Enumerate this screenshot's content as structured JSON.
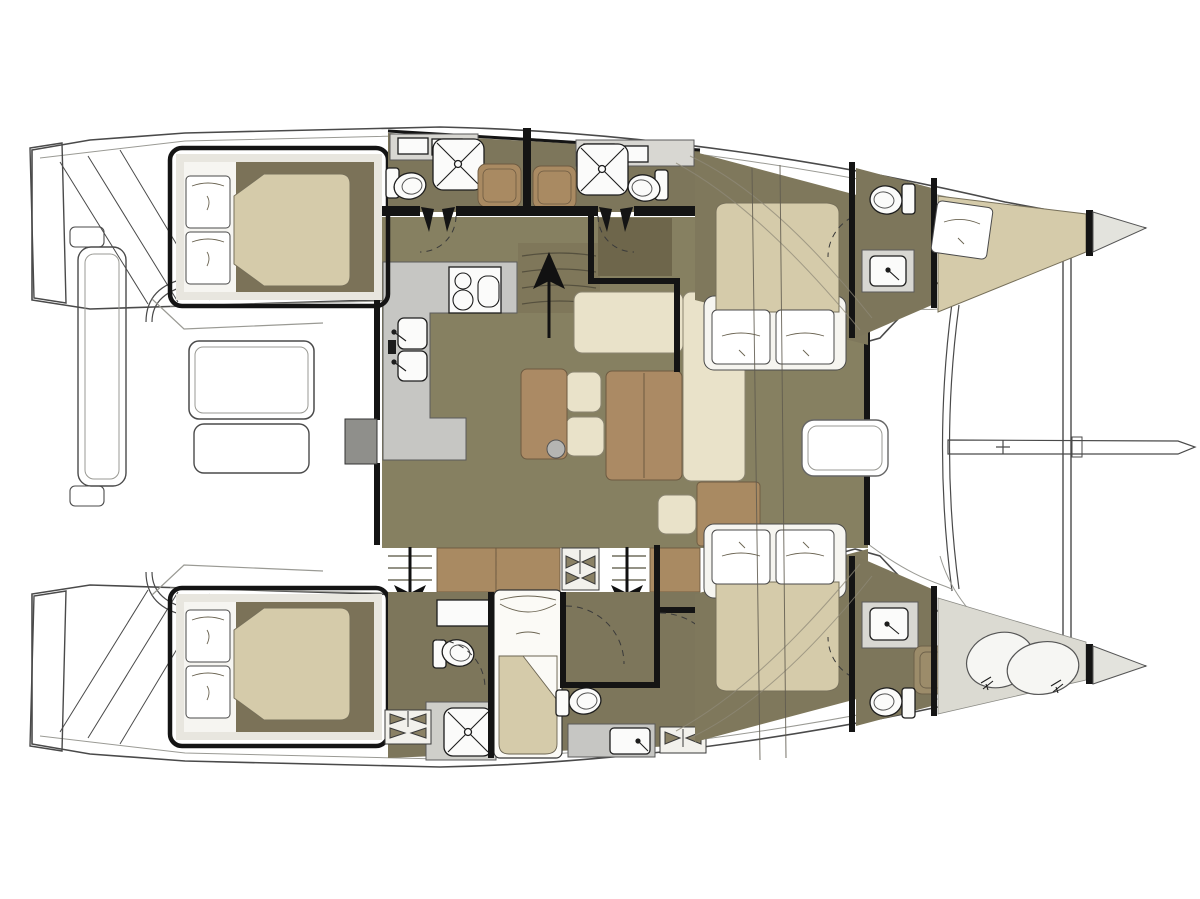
{
  "meta": {
    "description": "Catamaran yacht interior floor plan, top-down view, bow pointing right, stern with transom steps on the left; no text labels are printed on the drawing",
    "visible_text": "none"
  },
  "colors": {
    "paper": "#ffffff",
    "wall": "#141414",
    "outline": "#4a4a4a",
    "outline_light": "#9a9a94",
    "floor_salon": "#868061",
    "floor_cabin": "#7f785c",
    "floor_head": "#7d765b",
    "floor_dark": "#6e664b",
    "cabin_margin": "#e8e6df",
    "cabin_inner": "#7b7258",
    "bed": "#d5cbaa",
    "cream": "#e9e2c9",
    "table_brown": "#ab8a64",
    "cabinet_brown": "#a98a62",
    "counter_gray": "#c6c6c3",
    "panel_gray": "#d8d7d2",
    "shower_pan": "#cfcfca",
    "deck_light": "#dbdad2",
    "bow_tip": "#e3e3dd",
    "white_fixture": "#fbfbfa",
    "stool_gray": "#b5b5b2",
    "door_gray": "#8f8f8b",
    "teak_shower": "#9c8c6a"
  },
  "boat": {
    "type": "catamaran floor plan",
    "orientation": "bow right, stern left",
    "hulls": 2
  },
  "rooms": [
    {
      "id": "cockpit",
      "location": "aft center (left of plan)",
      "fixtures": [
        "cockpit table",
        "bench seat",
        "aft bench",
        "transom steps port",
        "transom steps starboard",
        "handrail rods"
      ]
    },
    {
      "id": "salon",
      "location": "center nacelle",
      "fixtures": [
        "L-shaped galley counter",
        "two-burner stove with pot",
        "double sink",
        "companionway steps with up arrow",
        "dinette table with two leaves",
        "L-shaped cream sofa",
        "two seat cushions",
        "side table",
        "round bar stool",
        "ottoman cushion",
        "forward deck door",
        "aft sliding door",
        "stairs down to port hull",
        "stairs down to starboard hull"
      ]
    },
    {
      "id": "port-hull",
      "location": "top hull",
      "fixtures": [
        "aft double cabin with two pillows",
        "aft bathroom with shower, toilet and vanity",
        "forward bathroom with shower, toilet and vanity",
        "forward double cabin with two pillows",
        "forward head with toilet and sink",
        "bow crew berth with pillow"
      ]
    },
    {
      "id": "starboard-hull",
      "location": "bottom hull",
      "fixtures": [
        "aft double cabin with two pillows",
        "aft bathroom with shower and toilet",
        "single berth cabin",
        "mid bathroom with toilet and sink counter",
        "forward double cabin with two pillows",
        "forward head with sink, teak shower and toilet",
        "bow storage with two sail bags"
      ]
    },
    {
      "id": "foredeck",
      "location": "right of salon",
      "fixtures": [
        "bridgedeck front arc",
        "forward crossbeam",
        "bowsprit",
        "deck hatch",
        "vent hatches"
      ]
    }
  ]
}
